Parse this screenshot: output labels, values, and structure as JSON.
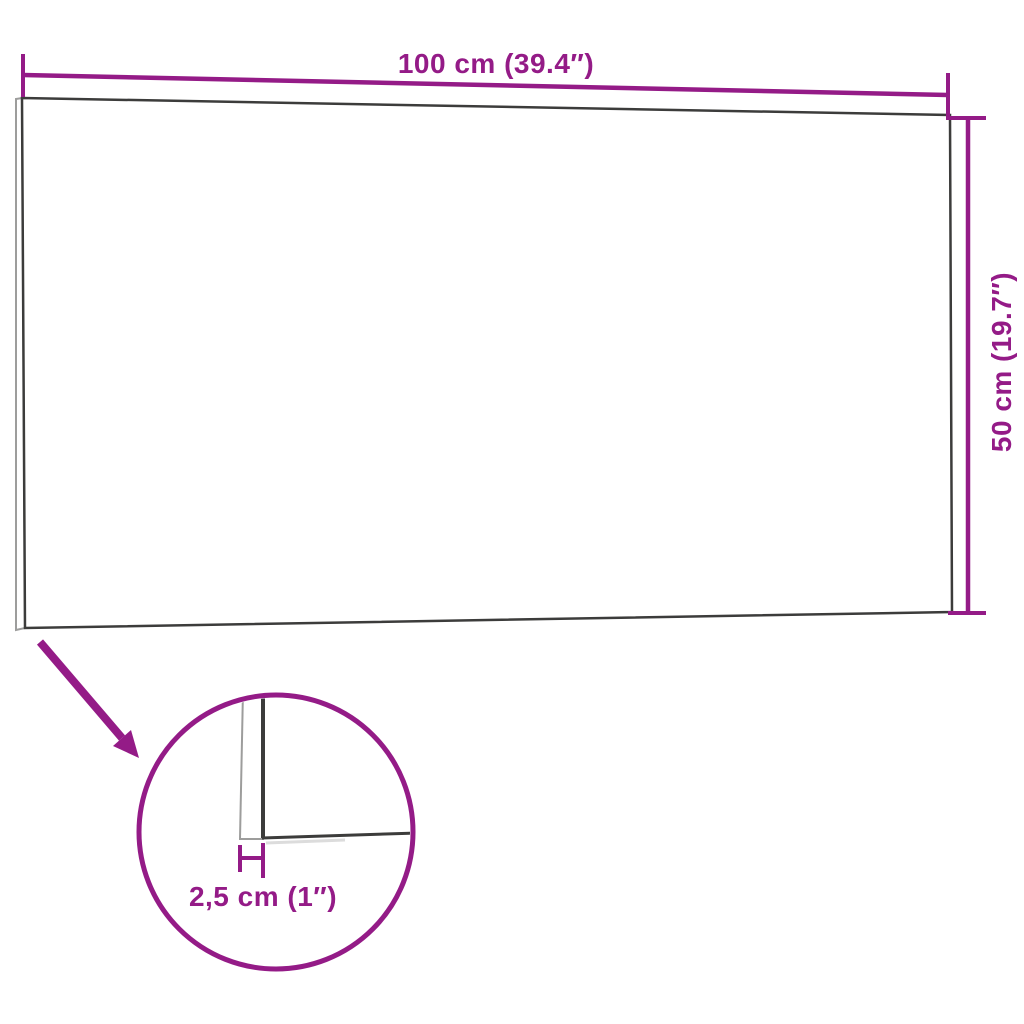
{
  "diagram": {
    "title": "Wall panel dimension diagram",
    "panel": {
      "width_label": "100 cm (39.4″)",
      "height_label": "50 cm (19.7″)",
      "thickness_label": "2,5 cm (1″)"
    },
    "colors": {
      "dimension_magenta": "#941B87",
      "outline_dark": "#3C3C3B",
      "outline_light": "#9D9D9C",
      "shadow_gray": "#DCDCDC",
      "background": "#FFFFFF"
    }
  }
}
